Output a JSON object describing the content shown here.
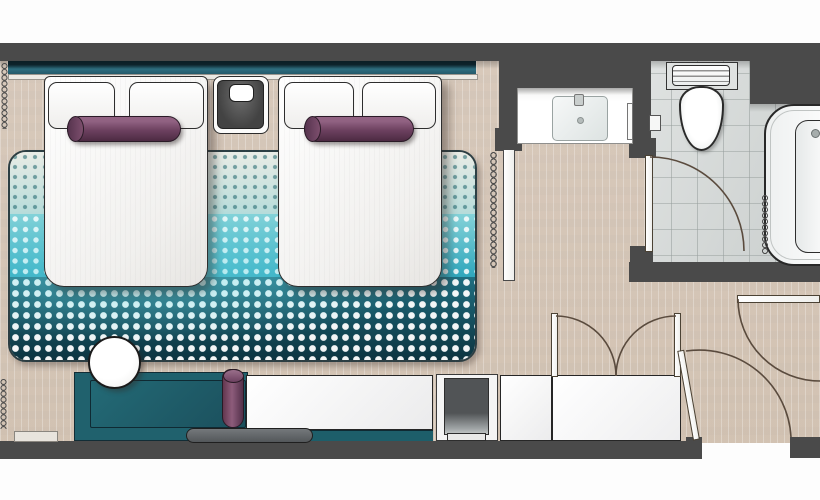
{
  "plan": {
    "kind": "hotel guest room floor plan",
    "rooms": [
      "bedroom",
      "vanity-nook",
      "bathroom",
      "entry-vestibule"
    ],
    "furniture": [
      "twin-bed-1",
      "twin-bed-2",
      "pillows",
      "bolster-cushion-1",
      "bolster-cushion-2",
      "nightstand",
      "area-rug",
      "bench-sofa",
      "bench-bolster",
      "side-table",
      "console-bench",
      "minibar-unit",
      "luggage-bench",
      "wardrobe",
      "entry-door",
      "vestibule-door",
      "bathroom-door",
      "vanity-sink",
      "toilet",
      "bathtub",
      "shower-curtain",
      "window-curtains"
    ]
  },
  "palette": {
    "wall": "#4a4a4a",
    "wood": "#d9cec2",
    "tile": "#d8dbda",
    "headboardTeal": "#2e6e80",
    "headboardNavy": "#0f2730",
    "rugCyan": "#2fa6bc",
    "rugNavy": "#0d3440",
    "benchTeal": "#20616d",
    "purple": "#6d4160",
    "arc": "#5a4b3e",
    "white": "#ffffff"
  }
}
